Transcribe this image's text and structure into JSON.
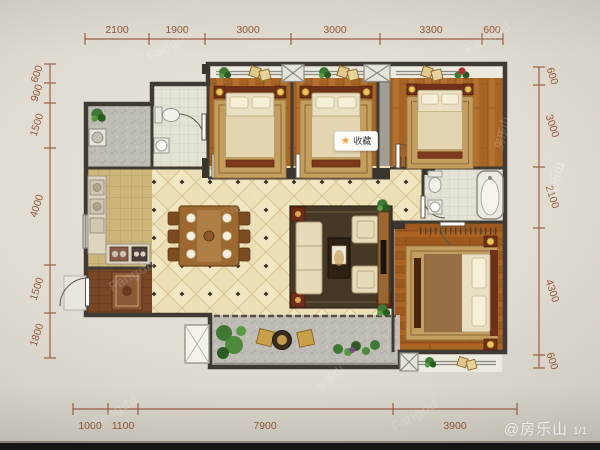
{
  "dims": {
    "top": [
      "2100",
      "1900",
      "3000",
      "3000",
      "3300",
      "600"
    ],
    "bottom": [
      "1000",
      "1100",
      "7900",
      "3900"
    ],
    "left": [
      "600",
      "900",
      "1500",
      "4000",
      "1500",
      "1800"
    ],
    "right": [
      "600",
      "3000",
      "2100",
      "4300",
      "600"
    ],
    "line_color": "#9a5f42",
    "text_color": "#93563a"
  },
  "badge": {
    "label": "收藏",
    "star_glyph": "★",
    "star_color": "#f0a43c",
    "background": "#fdfdfa"
  },
  "watermarks": {
    "credit": "@房乐山",
    "page": "1/1",
    "brand": "Fangdd",
    "site": "房乐山"
  },
  "plan_colors": {
    "wall": "#3f3a33",
    "wood_floor": "#b4702e",
    "living_tile": "#ecdfb6",
    "kitchen_tile": "#ccb67a",
    "bath_tile": "#e3e3d5",
    "balcony_floor": "#bebcb4"
  }
}
